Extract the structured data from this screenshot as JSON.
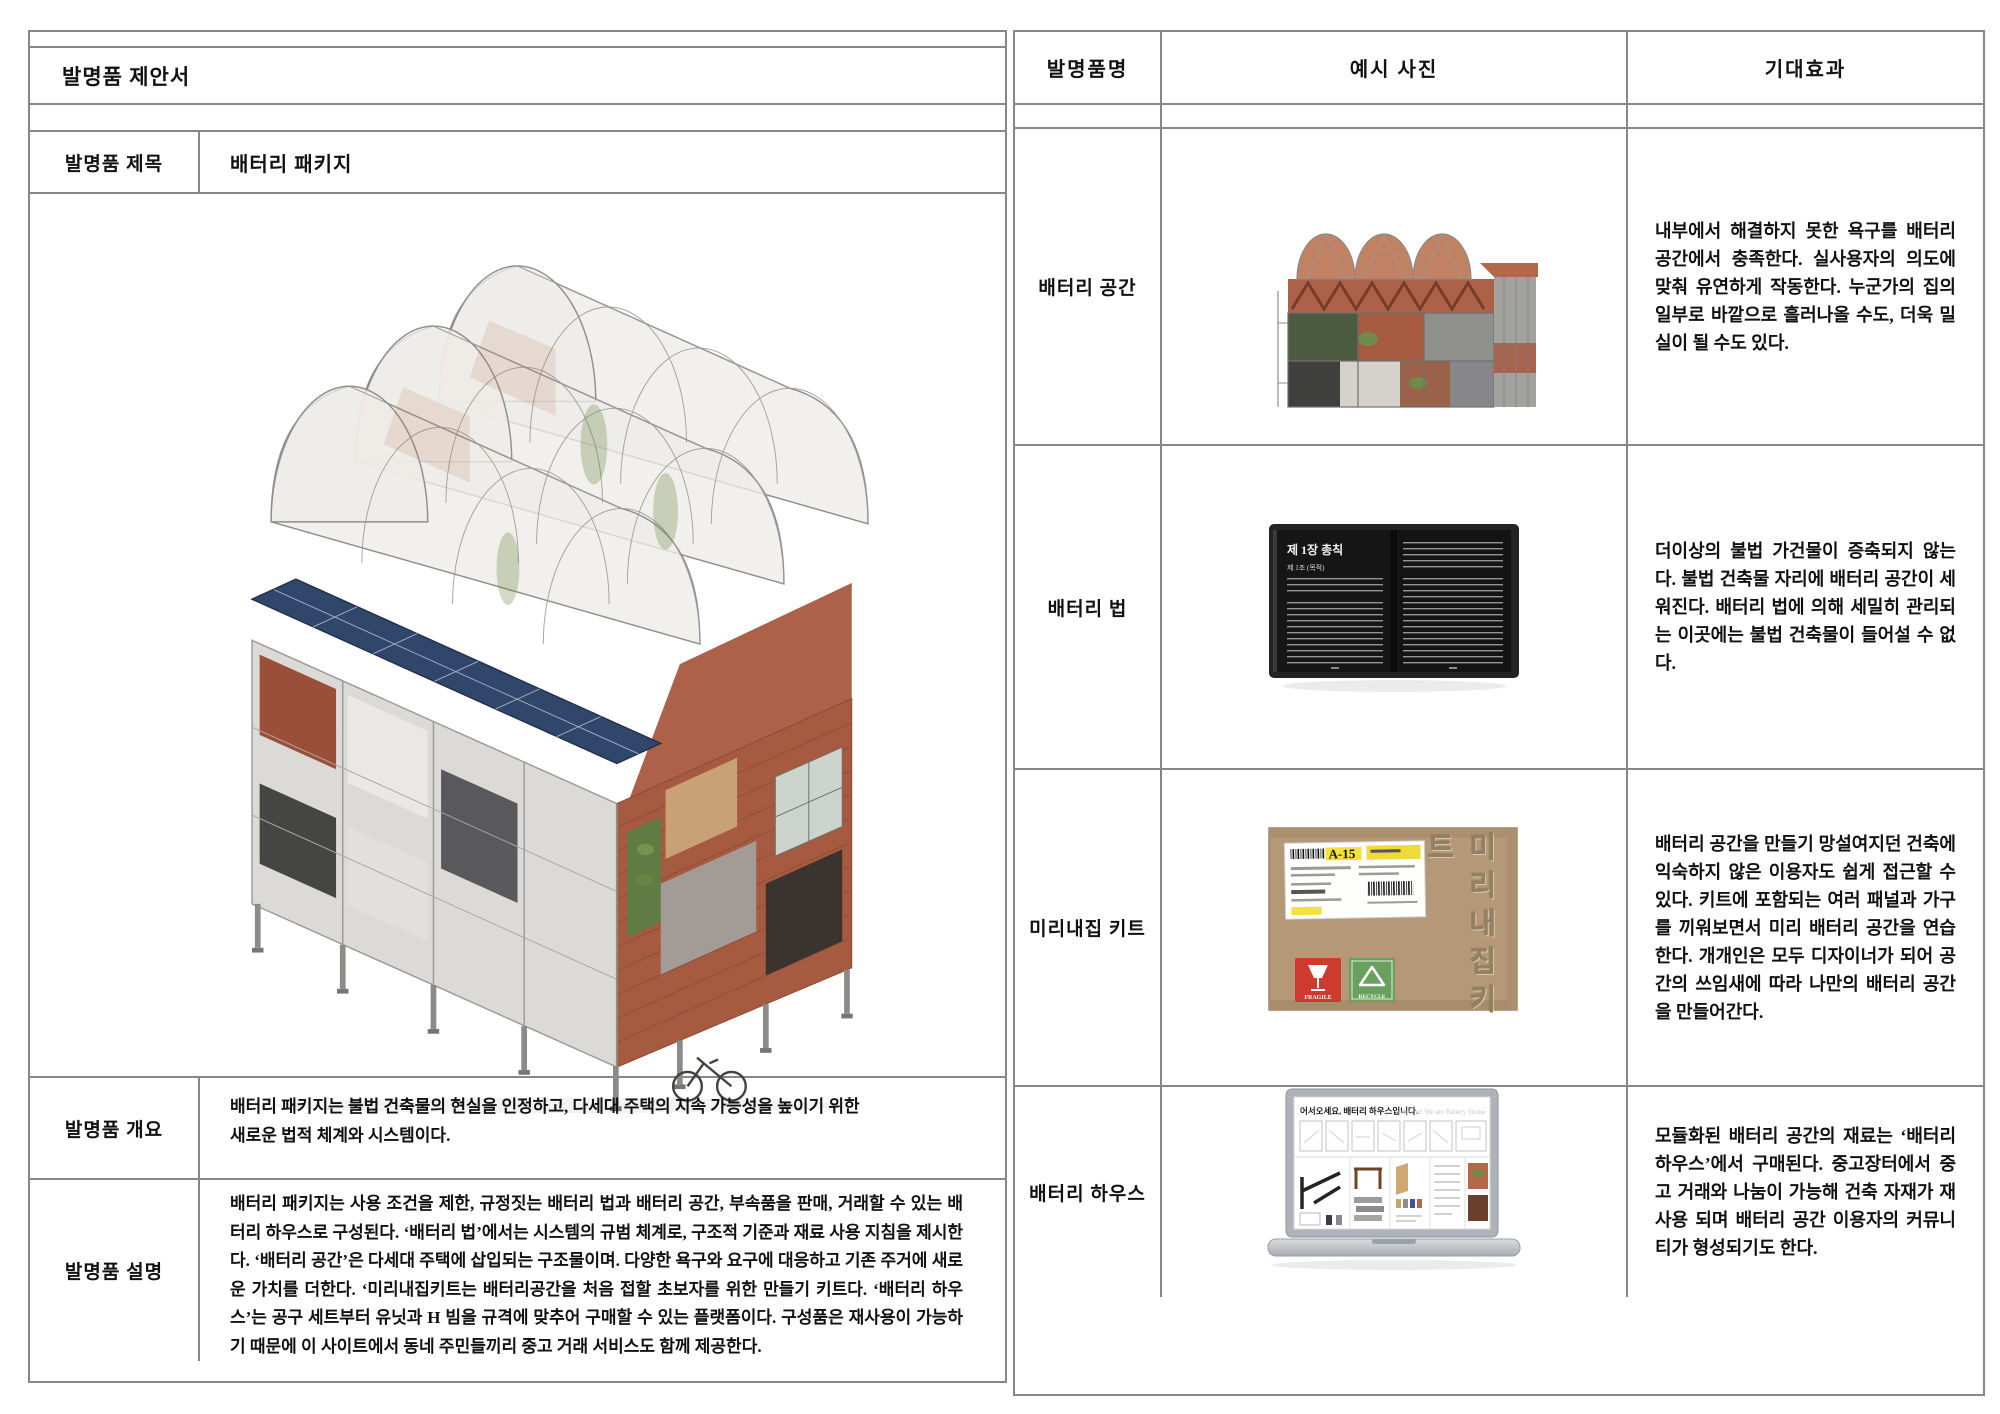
{
  "document": {
    "title": "발명품 제안서"
  },
  "left_table": {
    "title_row": {
      "label": "발명품 제목",
      "value": "배터리 패키지"
    },
    "overview": {
      "label": "발명품 개요",
      "line1": "배터리 패키지는 불법 건축물의 현실을 인정하고, 다세대 주택의 지속 가능성을 높이기 위한",
      "line2": "새로운 법적 체계와 시스템이다."
    },
    "description": {
      "label": "발명품 설명",
      "text": "배터리 패키지는 사용 조건을 제한, 규정짓는 배터리 법과 배터리 공간, 부속품을 판매, 거래할 수 있는 배터리 하우스로 구성된다. ‘배터리 법’에서는 시스템의 규범 체계로, 구조적 기준과 재료 사용 지침을 제시한다. ‘배터리 공간’은 다세대 주택에 삽입되는 구조물이며. 다양한 욕구와 요구에 대응하고 기존 주거에 새로운 가치를 더한다. ‘미리내집키트는 배터리공간을 처음 접할 초보자를 위한 만들기 키트다. ‘배터리 하우스’는 공구 세트부터 유닛과 H 빔을 규격에 맞추어 구매할 수 있는 플랫폼이다. 구성품은 재사용이 가능하기 때문에 이 사이트에서 동네 주민들끼리 중고 거래 서비스도 함께 제공한다."
    },
    "main_image": "battery-package-building-axonometric-rendering"
  },
  "right_table": {
    "headers": [
      "발명품명",
      "예시 사진",
      "기대효과"
    ],
    "rows": [
      {
        "name": "배터리 공간",
        "photo": "building-elevation-collage",
        "effect": "내부에서 해결하지 못한 욕구를 배터리 공간에서 충족한다. 실사용자의 의도에 맞춰 유연하게 작동한다. 누군가의 집의 일부로 바깥으로 흘러나올 수도, 더욱 밀실이 될 수도 있다."
      },
      {
        "name": "배터리 법",
        "photo": "open-law-book",
        "effect": "더이상의 불법 가건물이 증축되지 않는다. 불법 건축물 자리에 배터리 공간이 세워진다. 배터리 법에 의해 세밀히 관리되는 이곳에는 불법 건축물이 들어설 수 없다."
      },
      {
        "name": "미리내집 키트",
        "photo": "kraft-kit-box",
        "effect": "배터리 공간을 만들기 망설여지던 건축에 익숙하지 않은 이용자도 쉽게 접근할 수 있다. 키트에 포함되는 여러 패널과 가구를 끼워보면서 미리 배터리 공간을 연습한다. 개개인은 모두 디자이너가 되어 공간의 쓰임새에 따라 나만의 배터리 공간을 만들어간다."
      },
      {
        "name": "배터리 하우스",
        "photo": "laptop-battery-house-website",
        "effect": "모듈화된 배터리 공간의 재료는 ‘배터리 하우스’에서 구매된다. 중고장터에서 중고 거래와 나눔이 가능해 건축 자재가 재사용 되며 배터리 공간 이용자의 커뮤니티가 형성되기도 한다."
      }
    ]
  },
  "artwork": {
    "book": {
      "heading": "제 1장 총칙",
      "subheading": "제 1조 (목적)"
    },
    "kit_box": {
      "code": "A-15",
      "vertical_label": "미리내집키트",
      "fragile": "FRAGILE",
      "recycle": "RECYCLE"
    },
    "laptop": {
      "welcome_ko": "어서오세요, 배터리 하우스입니다.",
      "welcome_en": "Welcome! We are Battery House"
    }
  },
  "colors": {
    "table_border": "#878787",
    "brick": "#a65a40",
    "solar_blue": "#31466b",
    "kraft": "#b49878"
  }
}
